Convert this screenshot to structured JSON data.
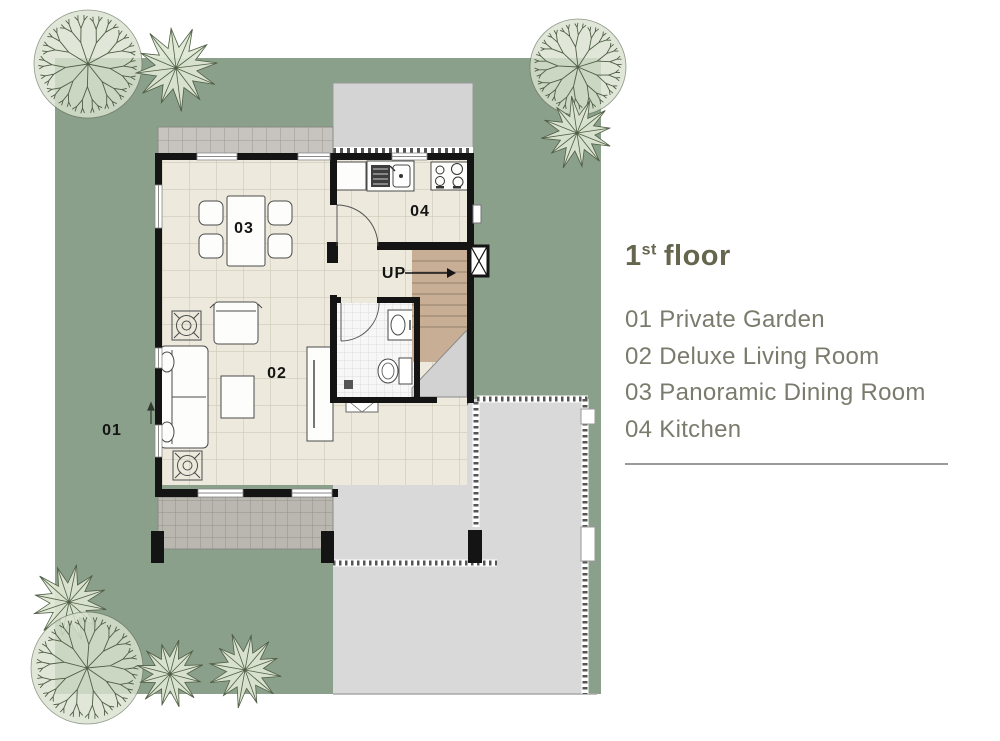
{
  "legend": {
    "title_number": "1",
    "title_sup": "st",
    "title_text": "floor",
    "items": [
      "01 Private Garden",
      "02 Deluxe Living Room",
      "03 Panoramic Dining Room",
      "04 Kitchen"
    ]
  },
  "plan": {
    "labels": {
      "garden": "01",
      "living": "02",
      "dining": "03",
      "kitchen": "04",
      "stairs_up": "UP"
    }
  },
  "colors": {
    "garden_green": "#8ba08b",
    "tree_fill": "#d9e2cf",
    "tree_stroke": "#4f5e45",
    "floor_beige": "#edeadd",
    "patio_gray": "#d9d9d9",
    "porch_gray": "#bab7b1",
    "stairs_brown": "#c9ae96",
    "wall_black": "#141414",
    "legend_title": "#66664f",
    "legend_text": "#7b7b6d"
  }
}
